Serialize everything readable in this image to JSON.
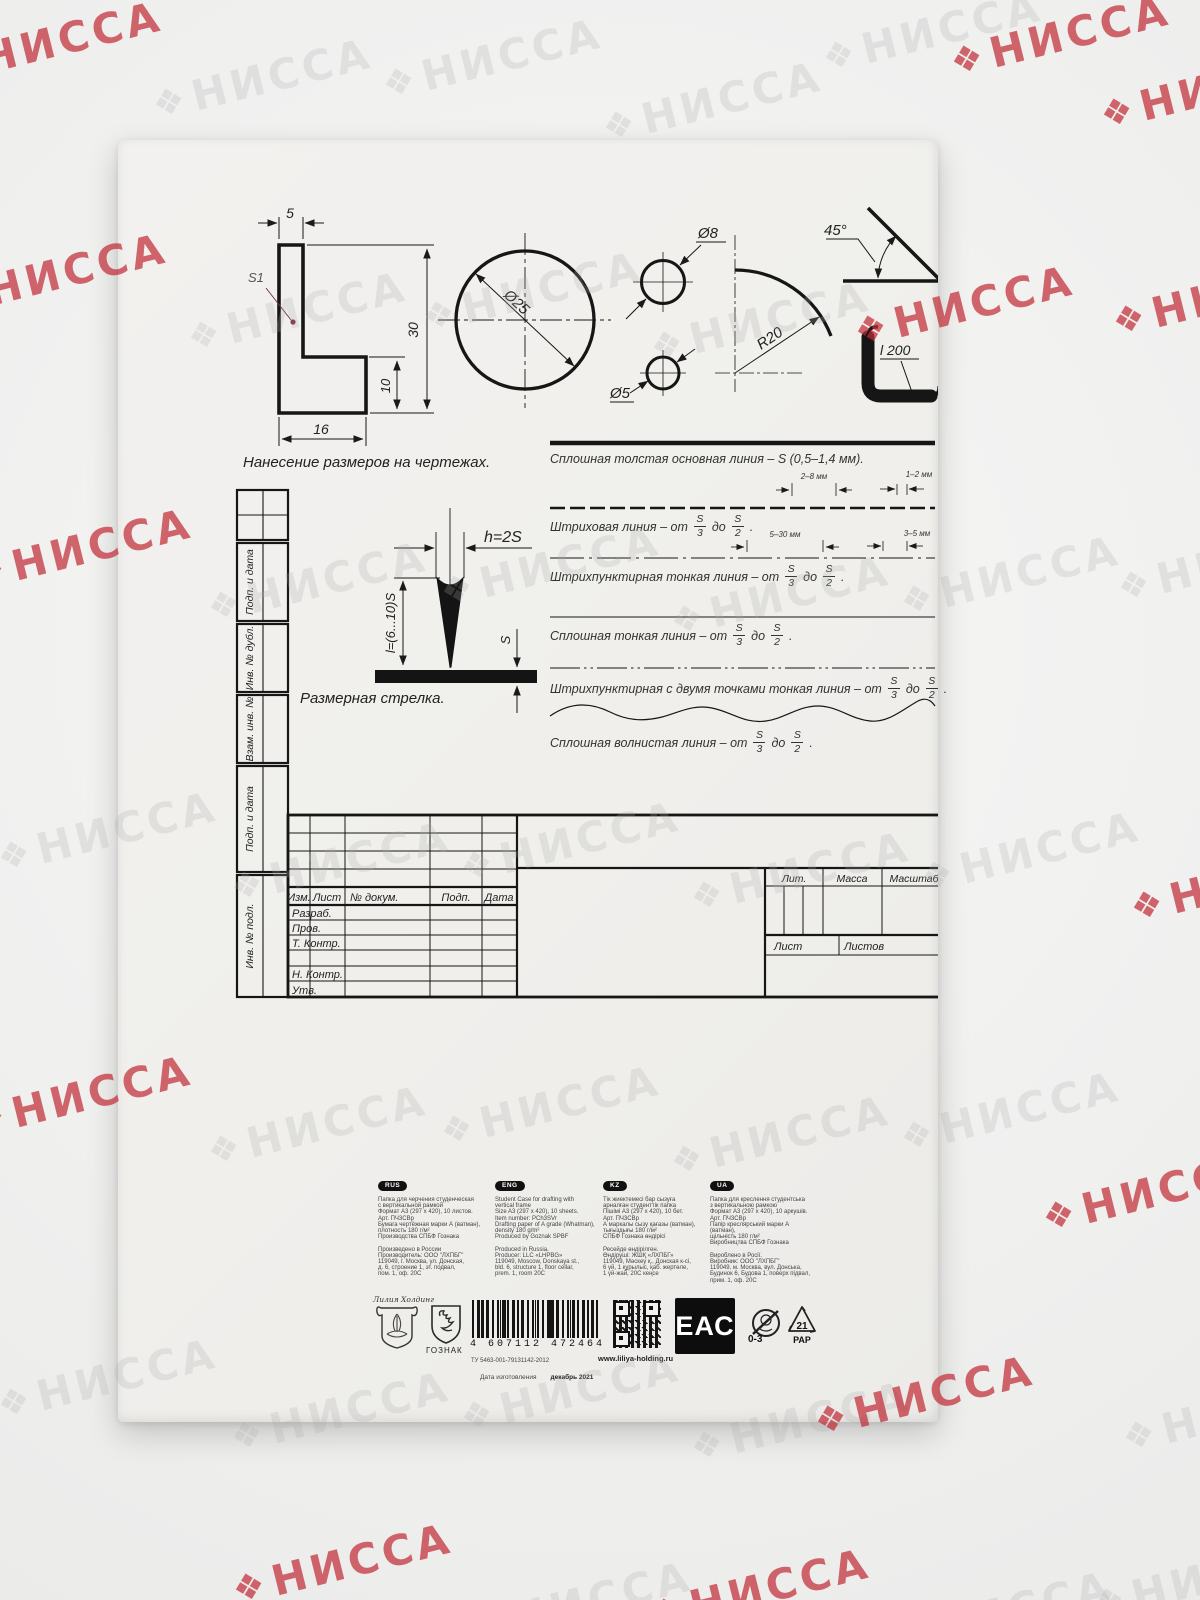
{
  "watermark": {
    "text": "НИССА",
    "icon": "❖",
    "gray_color": "#aaaaaa",
    "red_color": "#c22c38",
    "positions": [
      [
        -60,
        18,
        "red"
      ],
      [
        150,
        55,
        "gray"
      ],
      [
        380,
        35,
        "gray"
      ],
      [
        600,
        78,
        "gray"
      ],
      [
        820,
        8,
        "gray"
      ],
      [
        948,
        12,
        "red"
      ],
      [
        1098,
        65,
        "red"
      ],
      [
        -55,
        250,
        "red"
      ],
      [
        185,
        288,
        "gray"
      ],
      [
        420,
        268,
        "gray"
      ],
      [
        648,
        298,
        "gray"
      ],
      [
        852,
        282,
        "red"
      ],
      [
        1110,
        272,
        "red"
      ],
      [
        -30,
        525,
        "red"
      ],
      [
        205,
        558,
        "gray"
      ],
      [
        438,
        542,
        "gray"
      ],
      [
        668,
        572,
        "gray"
      ],
      [
        898,
        552,
        "gray"
      ],
      [
        1115,
        538,
        "gray"
      ],
      [
        -5,
        808,
        "gray"
      ],
      [
        228,
        838,
        "gray"
      ],
      [
        458,
        818,
        "gray"
      ],
      [
        688,
        848,
        "gray"
      ],
      [
        918,
        828,
        "gray"
      ],
      [
        1128,
        858,
        "red"
      ],
      [
        -30,
        1072,
        "red"
      ],
      [
        205,
        1102,
        "gray"
      ],
      [
        438,
        1082,
        "gray"
      ],
      [
        668,
        1112,
        "gray"
      ],
      [
        898,
        1088,
        "gray"
      ],
      [
        1040,
        1168,
        "red"
      ],
      [
        -5,
        1355,
        "gray"
      ],
      [
        228,
        1388,
        "gray"
      ],
      [
        458,
        1368,
        "gray"
      ],
      [
        688,
        1398,
        "gray"
      ],
      [
        812,
        1372,
        "red"
      ],
      [
        1120,
        1388,
        "gray"
      ],
      [
        230,
        1540,
        "red"
      ],
      [
        470,
        1578,
        "gray"
      ],
      [
        648,
        1565,
        "red"
      ],
      [
        890,
        1588,
        "gray"
      ],
      [
        1090,
        1555,
        "gray"
      ]
    ]
  },
  "figures": {
    "caption": "Нанесение размеров на чертежах.",
    "dims": {
      "top": "5",
      "height": "30",
      "step": "10",
      "width": "16",
      "surface": "S1",
      "d25": "Ø25",
      "d8": "Ø8",
      "d5": "Ø5",
      "r20": "R20",
      "angle": "45°",
      "profile": "l 200"
    }
  },
  "arrow_figure": {
    "h": "h=2S",
    "l": "l=(6...10)S",
    "s": "S",
    "caption": "Размерная стрелка."
  },
  "line_samples": {
    "s1": {
      "text": "Сплошная толстая основная линия – S (0,5–1,4 мм)."
    },
    "s2": {
      "prefix": "Штриховая линия – от",
      "num1": "S",
      "den1": "3",
      "mid": "до",
      "num2": "S",
      "den2": "2",
      "suffix": ".",
      "ann1": "2–8 мм",
      "ann2": "1–2 мм"
    },
    "s3": {
      "prefix": "Штрихпунктирная тонкая линия – от",
      "num1": "S",
      "den1": "3",
      "mid": "до",
      "num2": "S",
      "den2": "2",
      "suffix": ".",
      "ann1": "5–30 мм",
      "ann2": "3–5 мм"
    },
    "s4": {
      "prefix": "Сплошная тонкая линия – от",
      "num1": "S",
      "den1": "3",
      "mid": "до",
      "num2": "S",
      "den2": "2",
      "suffix": "."
    },
    "s5": {
      "prefix": "Штрихпунктирная с двумя точками тонкая линия – от",
      "num1": "S",
      "den1": "3",
      "mid": "до",
      "num2": "S",
      "den2": "2",
      "suffix": "."
    },
    "s6": {
      "prefix": "Сплошная волнистая линия – от",
      "num1": "S",
      "den1": "3",
      "mid": "до",
      "num2": "S",
      "den2": "2",
      "suffix": "."
    }
  },
  "title_block": {
    "strip_labels": [
      "Подп. и дата",
      "Инв. № дубл.",
      "Взам. инв. №",
      "Подп. и дата",
      "Инв. № подл."
    ],
    "header_cols": [
      "Изм.",
      "Лист",
      "№ докум.",
      "Подп.",
      "Дата"
    ],
    "rows": [
      "Разраб.",
      "Пров.",
      "Т. Контр.",
      "",
      "Н. Контр.",
      "Утв."
    ],
    "lit": "Лит.",
    "mass": "Масса",
    "scale": "Масштаб",
    "sheet": "Лист",
    "sheets": "Листов"
  },
  "info": {
    "rus": {
      "badge": "RUS",
      "text": "Папка для черчения студенческая\nс вертикальной рамкой\nФормат А3 (297 х 420), 10 листов.\nАрт. ПЧ3СВр\nБумага чертёжная марки А (ватман),\nплотность 180 г/м²\nПроизводства СПБФ Гознака\n\nПроизведено в России\nПроизводитель: ООО \"ЛХПБГ\"\n119049, г. Москва, ул. Донская,\nд. 6, строение 1, эт. подвал,\nпом. 1, оф. 20С"
    },
    "eng": {
      "badge": "ENG",
      "text": "Student Case for drafting with\nvertical frame\nSize A3 (297 x 420), 10 sheets.\nItem number: PCh3SVr\nDrafting paper of A grade (Whatman),\ndensity 180 g/m²\nProduced by Goznak SPBF\n\nProduced in Russia.\nProducer: LLC «LHPBG»\n119049, Moscow, Donskaya st.,\nbld. 6, structure 1, floor cellar,\nprem. 1, room 20C"
    },
    "kz": {
      "badge": "KZ",
      "text": "Тік жиектемесі бар сызуға\nарналған студенттік папка\nПішімі А3 (297 х 420), 10 бет.\nАрт. ПЧ3СВр\nА маркалы сызу қағазы (ватман),\nтығыздығы 180 г/м²\nСПБФ Гознака өндірісі\n\nРесейде өндірілген.\nӨндіруші: ЖШҚ «ЛХПБГ»\n119049, Мәскеу қ., Донская к-сі,\n6 үй, 1 құрылыс, қаб. жертөле,\n1 үй-жай, 20С кеңсе"
    },
    "ua": {
      "badge": "UA",
      "text": "Папка для креслення студентська\nз вертикальною рамкою\nФормат А3 (297 х 420), 10 аркушів.\nАрт. ПЧ3СВр\nПапір креслярський марки А (ватман),\nщільність 180 г/м²\nВиробництва СПБФ Гознака\n\nВироблено в Росії.\nВиробник: ООО \"ЛХПБГ\"\n119049, м. Москва, вул. Донська,\nБудинок 6, Будова 1, поверх підвал,\nприм. 1, оф. 20С"
    }
  },
  "footer": {
    "brand_script": "Лилия Холдинг",
    "goznak": "ГОЗНАК",
    "barcode_digits": "4 607112 472464",
    "tu": "ТУ 5463-001-79131142-2012",
    "website": "www.liliya-holding.ru",
    "eac": "ЕАС",
    "age": "0-3",
    "pap_num": "21",
    "pap": "PAP",
    "date_label": "Дата изготовления",
    "date_value": "декабрь 2021"
  }
}
